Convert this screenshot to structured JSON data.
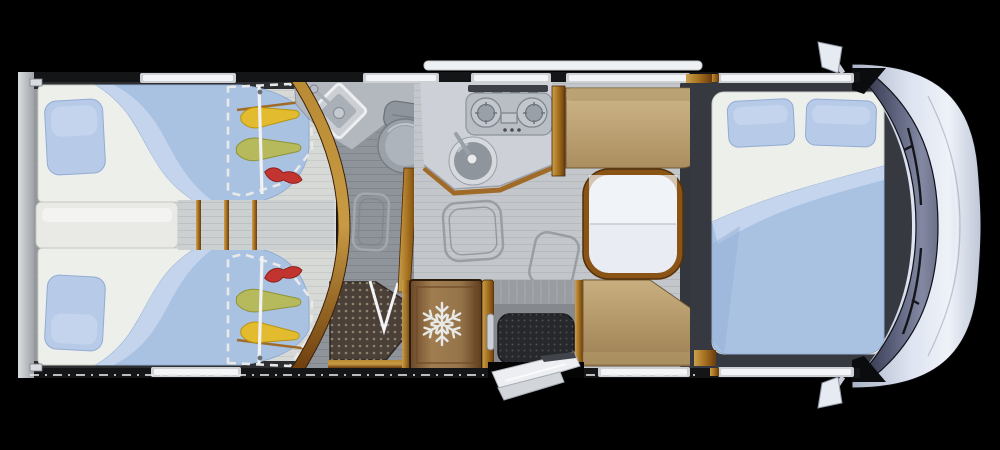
{
  "scene": "motorhome-floorplan-top-down-render",
  "icons": [
    {
      "name": "snowflake-icon",
      "meaning": "refrigerator"
    },
    {
      "name": "wardrobe-dashed-outline",
      "meaning": "optional wardrobe zone"
    },
    {
      "name": "hanging-clothes-icons",
      "meaning": "clothes on rail inside wardrobe zone"
    }
  ],
  "rooms": {
    "rear_bedroom": [
      "twin-bed-top",
      "twin-bed-bottom",
      "pillows",
      "center-step",
      "wardrobe-zone-top",
      "wardrobe-zone-bottom"
    ],
    "bathroom": [
      "corner-washbasin",
      "toilet",
      "shower-tray",
      "floor-hatch"
    ],
    "kitchen": [
      "two-burner-hob",
      "round-sink",
      "counter",
      "refrigerator"
    ],
    "entrance": [
      "entry-door-open",
      "door-mat",
      "grab-handle"
    ],
    "dinette": [
      "bench-seat-top",
      "bench-seat-bottom",
      "folding-table"
    ],
    "front_bedroom": [
      "double-bed",
      "pillows"
    ],
    "cab": [
      "windshield",
      "wipers",
      "hood",
      "side-mirror-top",
      "side-mirror-bottom"
    ]
  },
  "palette": {
    "bg": "#000000",
    "wall_dark": "#141517",
    "rear_wall": "#c3c7cb",
    "mattress": "#edefeb",
    "duvet": "#a9c2e2",
    "duvet_fold": "#c6d6ee",
    "pillow": "#b7cbe8",
    "wood_light": "#c89a44",
    "wood_dark": "#6b3c0c",
    "tan": "#c2a87a",
    "table_top": "#e9edf3",
    "table_rim": "#8a5416",
    "floor_gray": "#8f949b",
    "floor_light": "#c3c7cb",
    "counter": "#cdd1d7",
    "steel": "#b9bec5",
    "basin": "#8f959d",
    "toilet": "#9ba1a9",
    "shower_mat": "#4a4037",
    "fridge_brown": "#96744a",
    "snowflake": "#e8e8e6",
    "platform_dark": "#36393f",
    "entry_mat": "#26282c",
    "windshield_dark": "#3a3e54",
    "hood_light": "#dde3f0",
    "window_white": "#f2f4f6",
    "dash_white": "#e9e9e9",
    "mirror": "#e6ebf2",
    "accent_yellow": "#e2bc2e",
    "accent_olive": "#b6b95c",
    "accent_red": "#c23430"
  }
}
